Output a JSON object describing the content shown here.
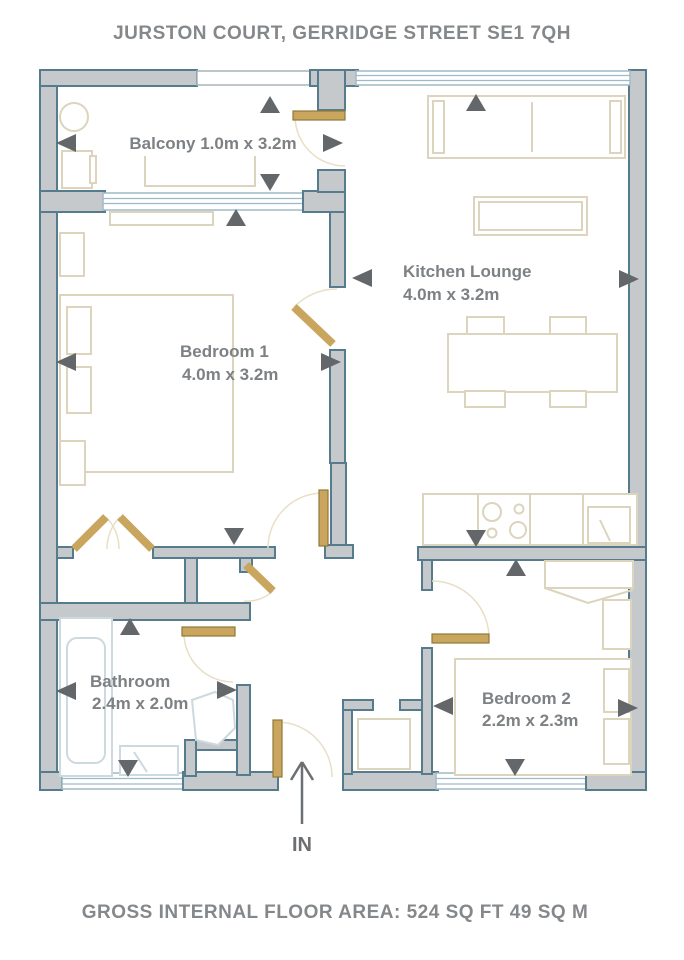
{
  "title": "JURSTON COURT, GERRIDGE STREET SE1 7QH",
  "footer": "GROSS INTERNAL FLOOR AREA: 524 SQ FT 49 SQ M",
  "entrance": {
    "label": "IN"
  },
  "rooms": {
    "balcony": {
      "label": "Balcony 1.0m x 3.2m"
    },
    "kitchen_lounge": {
      "name": "Kitchen Lounge",
      "dims": "4.0m x 3.2m"
    },
    "bedroom1": {
      "name": "Bedroom 1",
      "dims": "4.0m x 3.2m"
    },
    "bedroom2": {
      "name": "Bedroom 2",
      "dims": "2.2m x 2.3m"
    },
    "bathroom": {
      "name": "Bathroom",
      "dims": "2.4m x 2.0m"
    }
  },
  "colors": {
    "wall_fill": "#c5c9cb",
    "wall_outline": "#567b8d",
    "door": "#c9a55e",
    "furniture_outline": "#dcd4bc",
    "bath_fixture_outline": "#ccd9df",
    "window_glazing": "#9fbac7",
    "label_text": "#7d8184",
    "heading_text": "#85888b",
    "arrow": "#63676a"
  }
}
